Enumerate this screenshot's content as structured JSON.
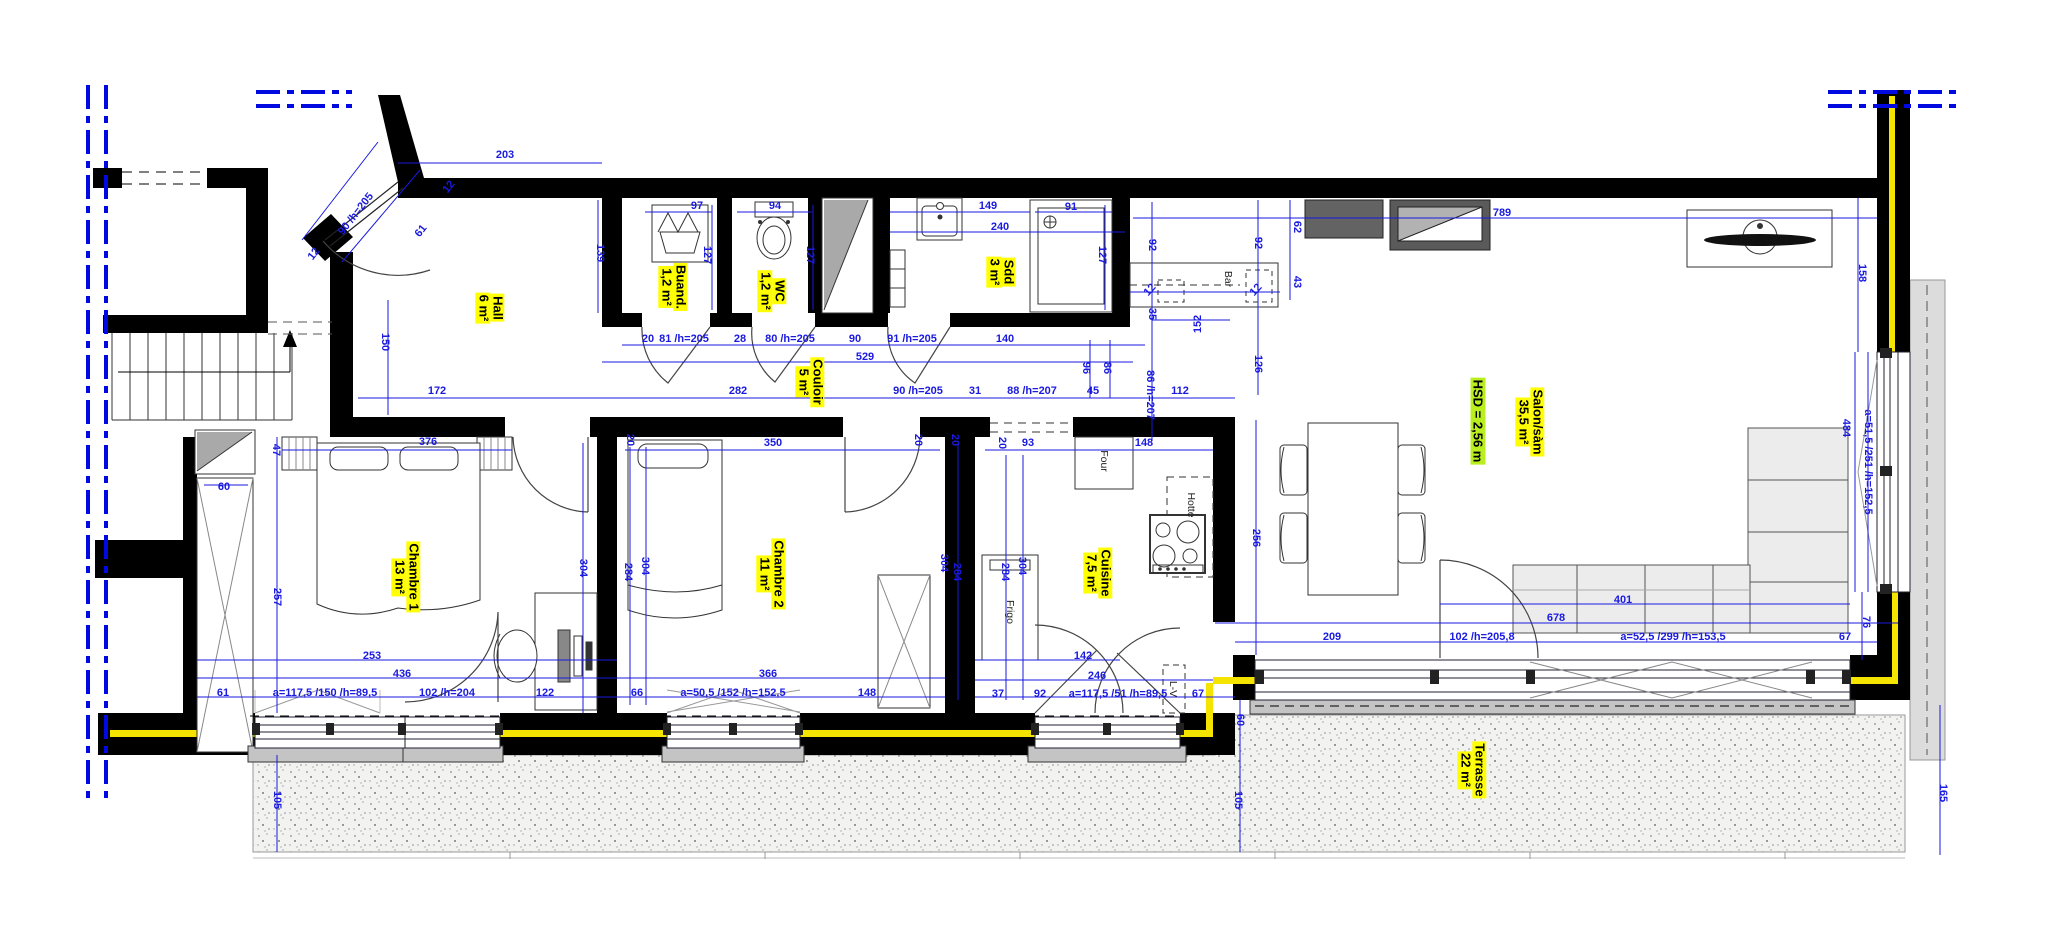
{
  "drawing": {
    "type": "apartment floor plan",
    "ceiling_height_label": "HSD = 2,56 m",
    "colors": {
      "dimension_blue": "#1a1ae0",
      "axis_blue": "#000ae0",
      "room_highlight": "#ffff00",
      "height_highlight": "#b9ef1f",
      "insulation_yellow": "#f5e300",
      "wall_black": "#000000"
    }
  },
  "rooms": [
    {
      "id": "hall",
      "label": "Hall",
      "area": "6 m²",
      "x": 490,
      "y": 308,
      "r": 90
    },
    {
      "id": "buanderie",
      "label": "Buand.",
      "area": "1,2 m²",
      "x": 673,
      "y": 287,
      "r": 90
    },
    {
      "id": "wc",
      "label": "WC",
      "area": "1,2 m²",
      "x": 772,
      "y": 291,
      "r": 90
    },
    {
      "id": "couloir",
      "label": "Couloir",
      "area": "5 m²",
      "x": 810,
      "y": 382,
      "r": 90
    },
    {
      "id": "salle-de-douche",
      "label": "Sdd",
      "area": "3 m²",
      "x": 1001,
      "y": 272,
      "r": 90
    },
    {
      "id": "chambre-1",
      "label": "Chambre 1",
      "area": "13 m²",
      "x": 406,
      "y": 577,
      "r": 90
    },
    {
      "id": "chambre-2",
      "label": "Chambre 2",
      "area": "11 m²",
      "x": 771,
      "y": 574,
      "r": 90
    },
    {
      "id": "cuisine",
      "label": "Cuisine",
      "area": "7,5 m²",
      "x": 1098,
      "y": 573,
      "r": 90
    },
    {
      "id": "salon-sam",
      "label": "Salon/sàm",
      "area": "35,5 m²",
      "x": 1530,
      "y": 422,
      "r": 90
    },
    {
      "id": "terrasse",
      "label": "Terrasse",
      "area": "22 m²",
      "x": 1472,
      "y": 770,
      "r": 90
    }
  ],
  "ceiling": {
    "label": "HSD = 2,56 m",
    "x": 1478,
    "y": 421,
    "r": 90
  },
  "fixtures": [
    {
      "t": "Four",
      "x": 1104,
      "y": 461,
      "r": 90
    },
    {
      "t": "Hotte",
      "x": 1191,
      "y": 505,
      "r": 90
    },
    {
      "t": "Frigo",
      "x": 1010,
      "y": 612,
      "r": 90
    },
    {
      "t": "L-V",
      "x": 1173,
      "y": 689,
      "r": 90
    },
    {
      "t": "Bar",
      "x": 1228,
      "y": 279,
      "r": 90
    }
  ],
  "dims": [
    {
      "t": "203",
      "x": 505,
      "y": 155
    },
    {
      "t": "90 /h=205",
      "x": 356,
      "y": 214,
      "r": -52
    },
    {
      "t": "61",
      "x": 421,
      "y": 231,
      "r": -52
    },
    {
      "t": "12",
      "x": 314,
      "y": 254,
      "r": -52
    },
    {
      "t": "12",
      "x": 449,
      "y": 187,
      "r": -52
    },
    {
      "t": "139",
      "x": 600,
      "y": 253,
      "r": 90
    },
    {
      "t": "150",
      "x": 385,
      "y": 342,
      "r": 90
    },
    {
      "t": "172",
      "x": 437,
      "y": 391
    },
    {
      "t": "97",
      "x": 697,
      "y": 206
    },
    {
      "t": "94",
      "x": 775,
      "y": 206
    },
    {
      "t": "127",
      "x": 707,
      "y": 255,
      "r": 90
    },
    {
      "t": "127",
      "x": 810,
      "y": 255,
      "r": 90
    },
    {
      "t": "149",
      "x": 988,
      "y": 206
    },
    {
      "t": "240",
      "x": 1000,
      "y": 227
    },
    {
      "t": "91",
      "x": 1071,
      "y": 207
    },
    {
      "t": "127",
      "x": 1102,
      "y": 255,
      "r": 90
    },
    {
      "t": "20",
      "x": 648,
      "y": 339
    },
    {
      "t": "81 /h=205",
      "x": 684,
      "y": 339
    },
    {
      "t": "28",
      "x": 740,
      "y": 339
    },
    {
      "t": "80 /h=205",
      "x": 790,
      "y": 339
    },
    {
      "t": "90",
      "x": 855,
      "y": 339
    },
    {
      "t": "91 /h=205",
      "x": 912,
      "y": 339
    },
    {
      "t": "140",
      "x": 1005,
      "y": 339
    },
    {
      "t": "529",
      "x": 865,
      "y": 357
    },
    {
      "t": "282",
      "x": 738,
      "y": 391
    },
    {
      "t": "90 /h=205",
      "x": 918,
      "y": 391
    },
    {
      "t": "31",
      "x": 975,
      "y": 391
    },
    {
      "t": "88 /h=207",
      "x": 1032,
      "y": 391
    },
    {
      "t": "45",
      "x": 1093,
      "y": 391
    },
    {
      "t": "112",
      "x": 1180,
      "y": 391
    },
    {
      "t": "92",
      "x": 1152,
      "y": 245,
      "r": 90
    },
    {
      "t": "92",
      "x": 1258,
      "y": 243,
      "r": 90
    },
    {
      "t": "62",
      "x": 1297,
      "y": 227,
      "r": 90
    },
    {
      "t": "43",
      "x": 1297,
      "y": 282,
      "r": 90
    },
    {
      "t": "12",
      "x": 1150,
      "y": 290,
      "r": -48
    },
    {
      "t": "12",
      "x": 1256,
      "y": 290,
      "r": -48
    },
    {
      "t": "35",
      "x": 1152,
      "y": 314,
      "r": 90
    },
    {
      "t": "152",
      "x": 1198,
      "y": 324,
      "r": -90
    },
    {
      "t": "126",
      "x": 1258,
      "y": 364,
      "r": 90
    },
    {
      "t": "86 /h=207",
      "x": 1150,
      "y": 395,
      "r": 90
    },
    {
      "t": "96",
      "x": 1086,
      "y": 368,
      "r": 90
    },
    {
      "t": "86",
      "x": 1107,
      "y": 368,
      "r": 90
    },
    {
      "t": "789",
      "x": 1502,
      "y": 213
    },
    {
      "t": "158",
      "x": 1862,
      "y": 273,
      "r": 90
    },
    {
      "t": "484",
      "x": 1846,
      "y": 428,
      "r": 90
    },
    {
      "t": "a=51,5 /251 /h=152,5",
      "x": 1868,
      "y": 462,
      "r": 90
    },
    {
      "t": "76",
      "x": 1866,
      "y": 622,
      "r": 90
    },
    {
      "t": "67",
      "x": 1845,
      "y": 637
    },
    {
      "t": "47",
      "x": 276,
      "y": 450,
      "r": 90
    },
    {
      "t": "376",
      "x": 428,
      "y": 442
    },
    {
      "t": "20",
      "x": 630,
      "y": 440,
      "r": 90
    },
    {
      "t": "350",
      "x": 773,
      "y": 443
    },
    {
      "t": "20",
      "x": 918,
      "y": 440,
      "r": 90
    },
    {
      "t": "20",
      "x": 955,
      "y": 440,
      "r": 90
    },
    {
      "t": "20",
      "x": 1002,
      "y": 443,
      "r": 90
    },
    {
      "t": "93",
      "x": 1028,
      "y": 443
    },
    {
      "t": "148",
      "x": 1144,
      "y": 443
    },
    {
      "t": "60",
      "x": 224,
      "y": 487
    },
    {
      "t": "257",
      "x": 277,
      "y": 597,
      "r": 90
    },
    {
      "t": "304",
      "x": 583,
      "y": 568,
      "r": 90
    },
    {
      "t": "284",
      "x": 628,
      "y": 572,
      "r": 90
    },
    {
      "t": "304",
      "x": 645,
      "y": 566,
      "r": 90
    },
    {
      "t": "304",
      "x": 944,
      "y": 563,
      "r": 90
    },
    {
      "t": "284",
      "x": 957,
      "y": 572,
      "r": 90
    },
    {
      "t": "284",
      "x": 1005,
      "y": 572,
      "r": 90
    },
    {
      "t": "304",
      "x": 1022,
      "y": 566,
      "r": 90
    },
    {
      "t": "256",
      "x": 1256,
      "y": 538,
      "r": 90
    },
    {
      "t": "253",
      "x": 372,
      "y": 656
    },
    {
      "t": "436",
      "x": 402,
      "y": 674
    },
    {
      "t": "61",
      "x": 223,
      "y": 693
    },
    {
      "t": "a=117,5 /150 /h=89,5",
      "x": 325,
      "y": 693
    },
    {
      "t": "102 /h=204",
      "x": 447,
      "y": 693
    },
    {
      "t": "122",
      "x": 545,
      "y": 693
    },
    {
      "t": "366",
      "x": 768,
      "y": 674
    },
    {
      "t": "66",
      "x": 637,
      "y": 693
    },
    {
      "t": "a=50,5 /152 /h=152,5",
      "x": 733,
      "y": 693
    },
    {
      "t": "148",
      "x": 867,
      "y": 693
    },
    {
      "t": "142",
      "x": 1083,
      "y": 656
    },
    {
      "t": "246",
      "x": 1097,
      "y": 676
    },
    {
      "t": "37",
      "x": 998,
      "y": 694
    },
    {
      "t": "92",
      "x": 1040,
      "y": 694
    },
    {
      "t": "a=117,5 /51 /h=89,5",
      "x": 1118,
      "y": 694
    },
    {
      "t": "67",
      "x": 1198,
      "y": 694
    },
    {
      "t": "209",
      "x": 1332,
      "y": 637
    },
    {
      "t": "102 /h=205,8",
      "x": 1482,
      "y": 637
    },
    {
      "t": "a=52,5 /299 /h=153,5",
      "x": 1673,
      "y": 637
    },
    {
      "t": "678",
      "x": 1556,
      "y": 618
    },
    {
      "t": "401",
      "x": 1623,
      "y": 600
    },
    {
      "t": "60",
      "x": 1240,
      "y": 720,
      "r": 90
    },
    {
      "t": "105",
      "x": 1238,
      "y": 800,
      "r": 90
    },
    {
      "t": "105",
      "x": 277,
      "y": 800,
      "r": 90
    },
    {
      "t": "165",
      "x": 1943,
      "y": 793,
      "r": 90
    }
  ]
}
